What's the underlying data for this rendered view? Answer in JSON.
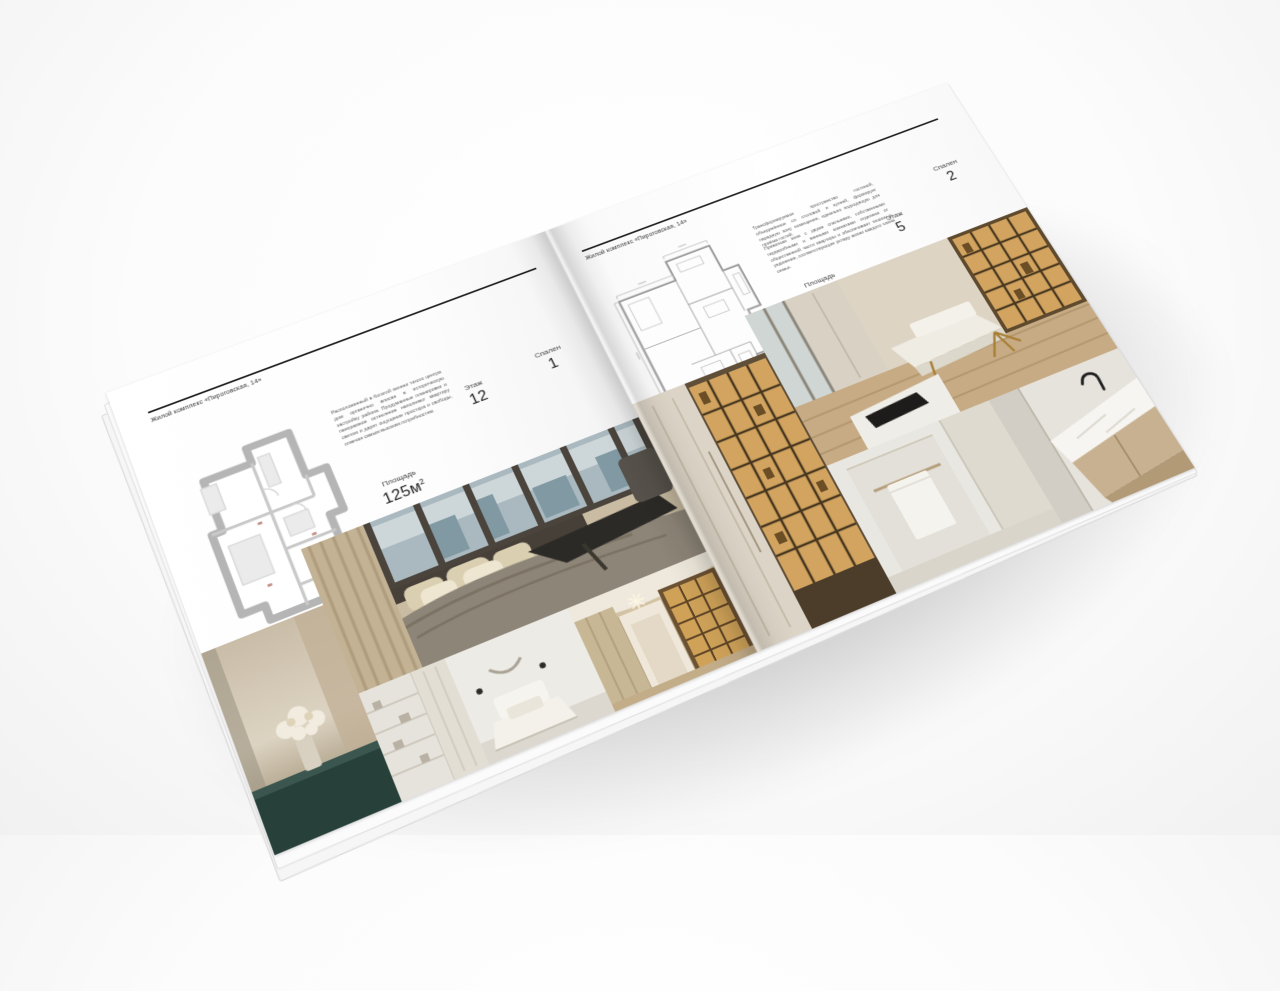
{
  "brochure": {
    "left_page": {
      "header": "Жилой комплекс «Пироговская, 14»",
      "description": "Расположенный в богатой зелени тихого центра дом органично вписан в историческую застройку района. Продуманные планировки и панорамное остекление наполняют квартиру светом и дарят ощущение простора и свободы, отвечая самым высоким потребностям.",
      "stats": {
        "area_label": "Площадь",
        "area_value": "125м",
        "area_sup": "2",
        "floor_label": "Этаж",
        "floor_value": "12",
        "bedrooms_label": "Спален",
        "bedrooms_value": "1"
      }
    },
    "right_page": {
      "header": "Жилой комплекс «Пироговская, 14»",
      "description_1": "Трансформируемое пространство гостиной, объединённое со столовой и кухней, формирует парадную зону помещения, идеально подходящую для приёма гостей.",
      "description_2": "Приватная зона с двумя спальнями, собственными гардеробными и ванными комнатами отделена от общественной части квартиры и обеспечивает тишину и уединение, соответствующие укладу жизни каждого члена семьи.",
      "stats": {
        "area_label": "Площадь",
        "area_value": "200м",
        "area_sup": "2",
        "floor_label": "Этаж",
        "floor_value": "5",
        "bedrooms_label": "Спален",
        "bedrooms_value": "2"
      }
    },
    "colors": {
      "paper": "#ffffff",
      "ink": "#1d1d1d",
      "muted_text": "#5c5c5c",
      "plan_walls_left": "#b5b5b5",
      "plan_walls_right": "#9d9d9d",
      "shelf_glow_amber": "#d2a45f",
      "table_teal": "#27403a",
      "wood_floor": "#c6ab84"
    }
  }
}
